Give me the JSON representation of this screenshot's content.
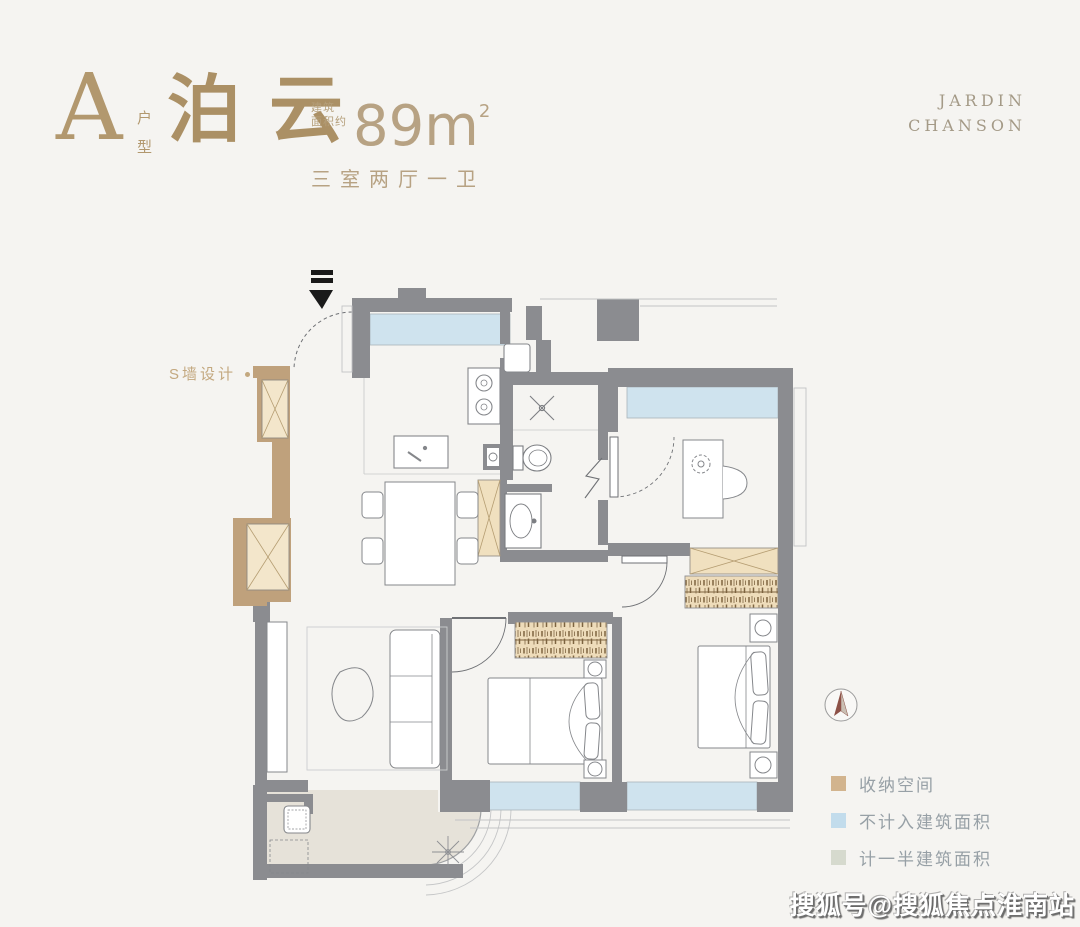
{
  "header": {
    "unit_letter": "A",
    "unit_type_label": "户型",
    "plan_name": "泊云",
    "area_label_line1": "建筑",
    "area_label_line2": "面积约",
    "area_number": "89",
    "area_unit": "m",
    "area_exponent": "2",
    "rooms_desc": "三室两厅一卫"
  },
  "brand": {
    "line1": "JARDIN",
    "line2": "CHANSON"
  },
  "floorplan": {
    "s_wall_label": "S墙设计"
  },
  "legend": {
    "items": [
      {
        "label": "收纳空间",
        "color": "#d2b48e"
      },
      {
        "label": "不计入建筑面积",
        "color": "#c2dcec"
      },
      {
        "label": "计一半建筑面积",
        "color": "#d6dace"
      }
    ]
  },
  "watermark": "搜狐号@搜狐焦点淮南站",
  "colors": {
    "background": "#f5f4f1",
    "wall": "#8b8c90",
    "storage_wall": "#bfa17c",
    "cabinet_fill": "#f3e6cb",
    "window": "#cfe3ee",
    "balcony_floor": "#e6e2d9",
    "accent_gold": "#b2986e"
  }
}
